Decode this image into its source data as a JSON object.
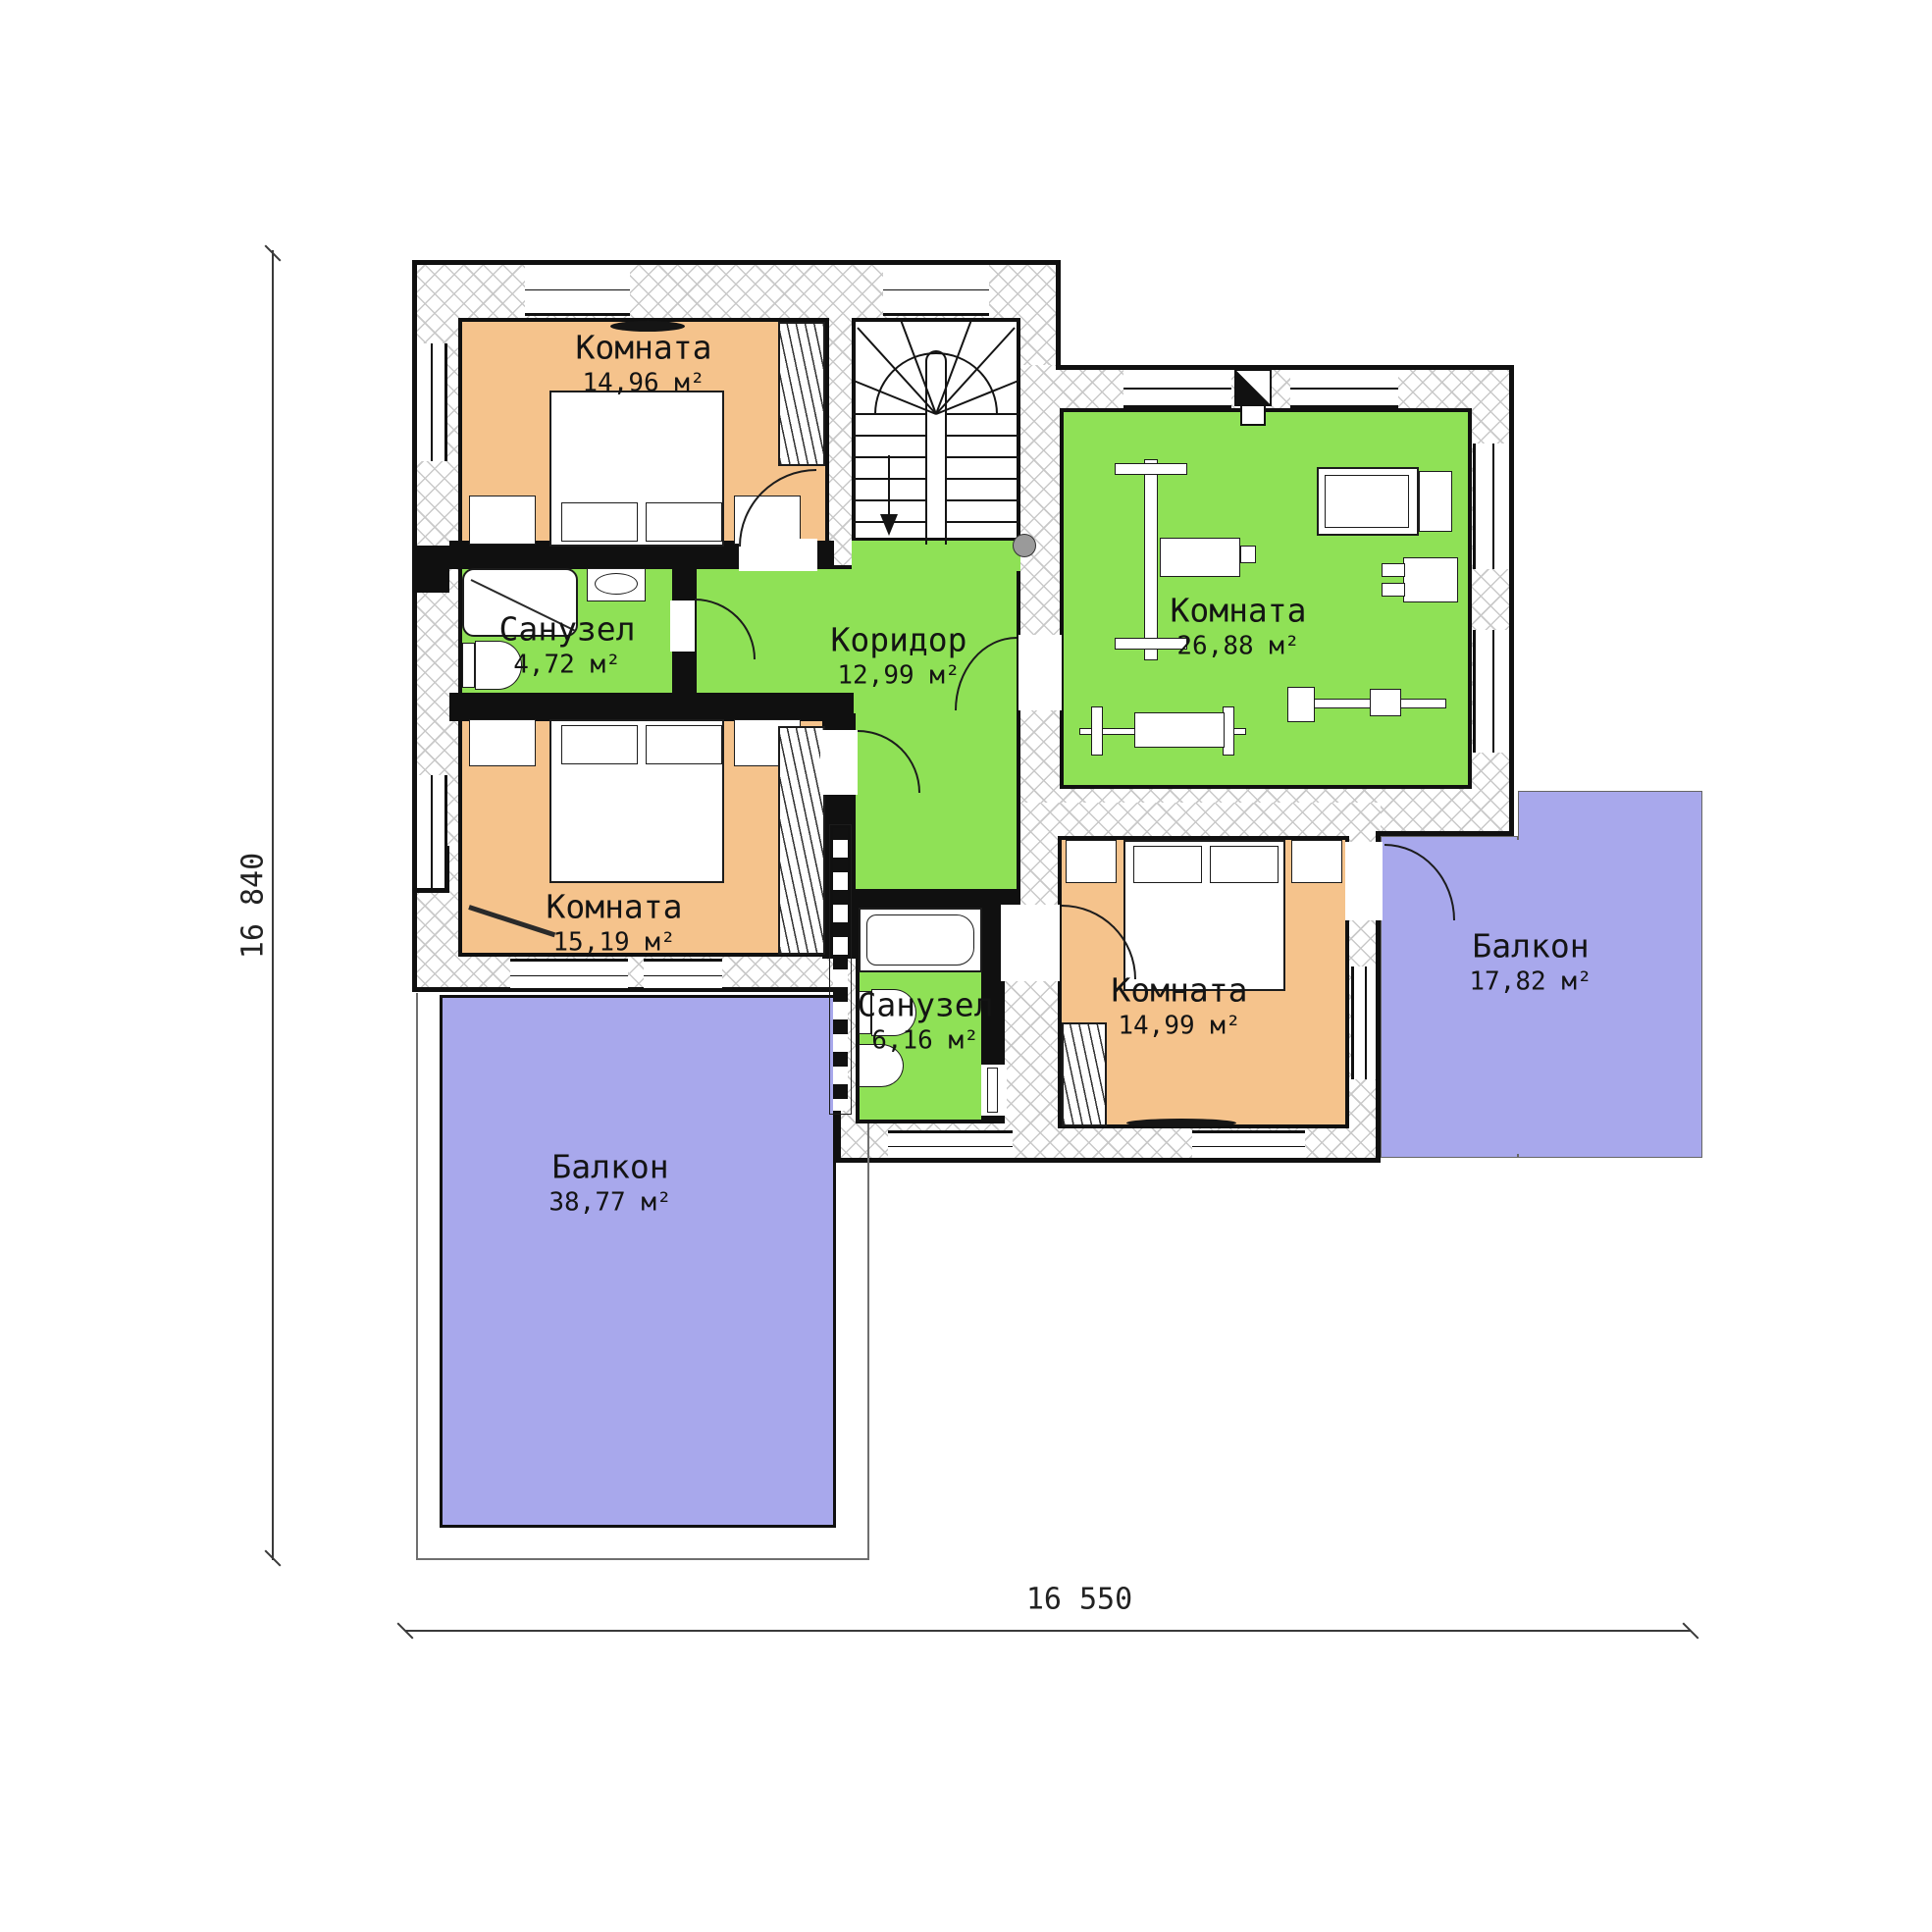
{
  "floorplan": {
    "rooms": [
      {
        "id": "bedroom-1",
        "name": "Комната",
        "area": "14,96",
        "unit": "м²",
        "fill": "orange"
      },
      {
        "id": "bathroom-1",
        "name": "Санузел",
        "area": "4,72",
        "unit": "м²",
        "fill": "green"
      },
      {
        "id": "corridor",
        "name": "Коридор",
        "area": "12,99",
        "unit": "м²",
        "fill": "green"
      },
      {
        "id": "gym-room",
        "name": "Комната",
        "area": "26,88",
        "unit": "м²",
        "fill": "green"
      },
      {
        "id": "bedroom-2",
        "name": "Комната",
        "area": "15,19",
        "unit": "м²",
        "fill": "orange"
      },
      {
        "id": "bathroom-2",
        "name": "Санузел",
        "area": "6,16",
        "unit": "м²",
        "fill": "green"
      },
      {
        "id": "bedroom-3",
        "name": "Комната",
        "area": "14,99",
        "unit": "м²",
        "fill": "orange"
      },
      {
        "id": "balcony-right",
        "name": "Балкон",
        "area": "17,82",
        "unit": "м²",
        "fill": "purple"
      },
      {
        "id": "balcony-left",
        "name": "Балкон",
        "area": "38,77",
        "unit": "м²",
        "fill": "purple"
      }
    ],
    "dimensions": {
      "vertical": "16 840",
      "horizontal": "16 550"
    },
    "colors": {
      "room_orange": "#f5c38c",
      "room_green": "#8fe156",
      "balcony_purple": "#a8a8ec",
      "wall_black": "#101010",
      "hatch_grey": "#c9c9c9"
    }
  }
}
